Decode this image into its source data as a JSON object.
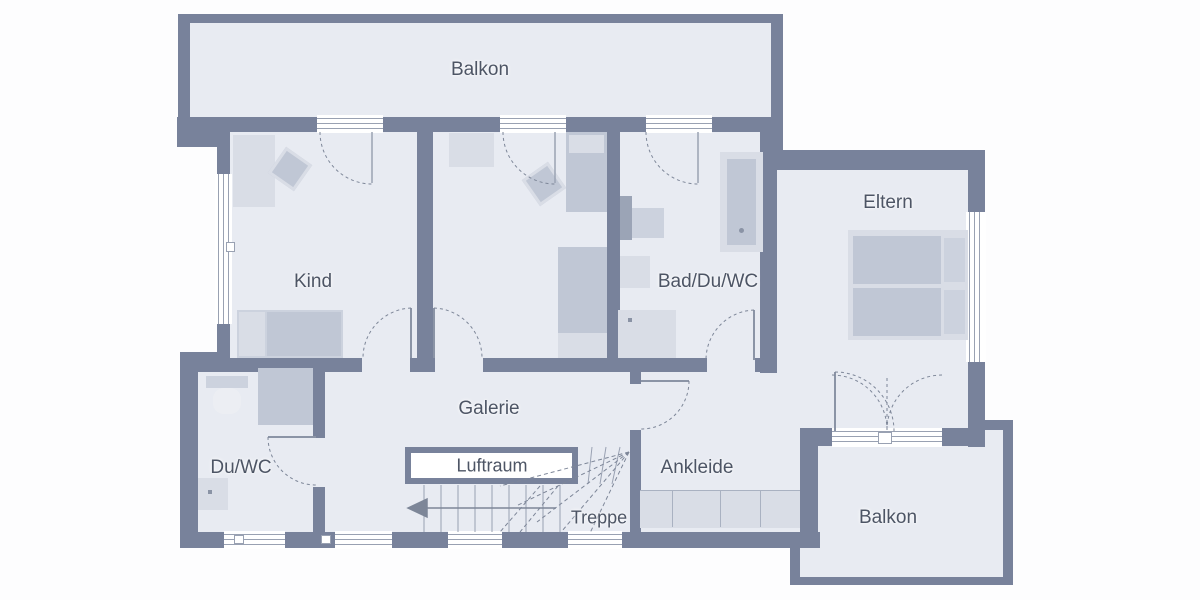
{
  "floorplan": {
    "type": "floor-plan",
    "language": "de",
    "rooms": {
      "balkon_top": {
        "label": "Balkon"
      },
      "kind": {
        "label": "Kind"
      },
      "bad": {
        "label": "Bad/Du/WC"
      },
      "eltern": {
        "label": "Eltern"
      },
      "galerie": {
        "label": "Galerie"
      },
      "du_wc": {
        "label": "Du/WC"
      },
      "luftraum": {
        "label": "Luftraum"
      },
      "treppe": {
        "label": "Treppe"
      },
      "ankleide": {
        "label": "Ankleide"
      },
      "balkon_bottom": {
        "label": "Balkon"
      }
    },
    "colors": {
      "wall": "#78829b",
      "room": "#e8ebf2",
      "furn_light": "#d9dde6",
      "furn_mid": "#ccd2de",
      "furn_dark": "#c0c7d5",
      "accent_dark": "#9ba4b6",
      "line": "#7d8698",
      "line2": "#99a1b2",
      "text": "#4d5565"
    }
  }
}
